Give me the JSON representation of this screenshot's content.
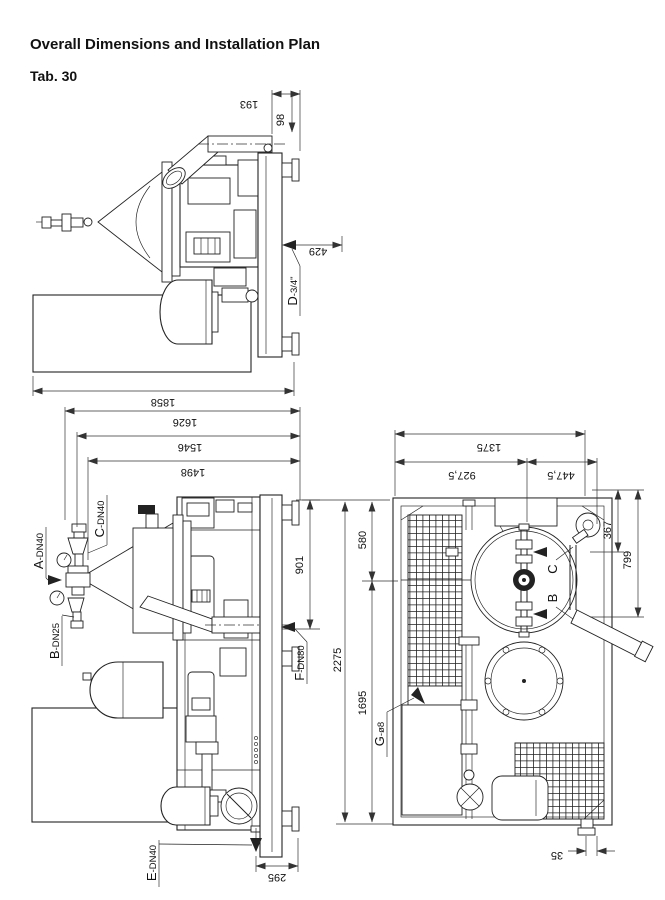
{
  "header": {
    "title": "Overall Dimensions and Installation Plan",
    "tab": "Tab. 30"
  },
  "side": {
    "d193": "193",
    "d98": "98",
    "d429": "429",
    "d1858": "1858",
    "portD": {
      "letter": "D",
      "size": "-3/4\""
    }
  },
  "front": {
    "d1626": "1626",
    "d1546": "1546",
    "d1498": "1498",
    "d901": "901",
    "d295": "295",
    "portA": {
      "letter": "A",
      "size": "-DN40"
    },
    "portB": {
      "letter": "B",
      "size": "-DN25"
    },
    "portC": {
      "letter": "C",
      "size": "-DN40"
    },
    "portE": {
      "letter": "E",
      "size": "-DN40"
    },
    "portF": {
      "letter": "F",
      "size": "-DN80"
    }
  },
  "plan": {
    "d1375": "1375",
    "d927": "927,5",
    "d447": "447,5",
    "d367": "367",
    "d799": "799",
    "d580": "580",
    "d1695": "1695",
    "d2275": "2275",
    "d35": "35",
    "portG": {
      "letter": "G",
      "size": "-ø8"
    },
    "labelB": "B",
    "labelC": "C"
  }
}
